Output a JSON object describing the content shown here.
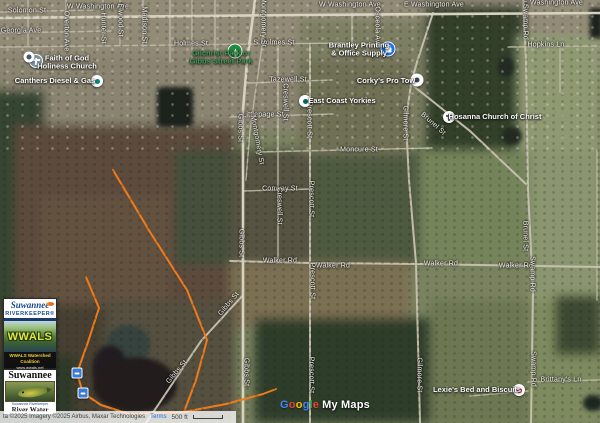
{
  "map": {
    "street_labels": [
      {
        "text": "Solomon St",
        "x": 27,
        "y": 11,
        "rot": 0
      },
      {
        "text": "W Washington Ave",
        "x": 98,
        "y": 7,
        "rot": 0
      },
      {
        "text": "W Washington Ave",
        "x": 350,
        "y": 5,
        "rot": 0
      },
      {
        "text": "E Washington Ave",
        "x": 434,
        "y": 5,
        "rot": 0
      },
      {
        "text": "E Washington Ave",
        "x": 553,
        "y": 3,
        "rot": 0
      },
      {
        "text": "Georgia Ave",
        "x": 21,
        "y": 31,
        "rot": 0
      },
      {
        "text": "Holmes St",
        "x": 191,
        "y": 44,
        "rot": 0
      },
      {
        "text": "S Holmes St",
        "x": 274,
        "y": 43,
        "rot": 0
      },
      {
        "text": "Tazewell St",
        "x": 288,
        "y": 80,
        "rot": 0
      },
      {
        "text": "Littlepage St",
        "x": 263,
        "y": 115,
        "rot": 0
      },
      {
        "text": "Moncure St",
        "x": 359,
        "y": 150,
        "rot": 0
      },
      {
        "text": "Conway St",
        "x": 280,
        "y": 189,
        "rot": 0
      },
      {
        "text": "Walker Rd",
        "x": 280,
        "y": 261,
        "rot": 0
      },
      {
        "text": "Walker Rd",
        "x": 333,
        "y": 266,
        "rot": 0
      },
      {
        "text": "Walker Rd",
        "x": 441,
        "y": 264,
        "rot": 0
      },
      {
        "text": "Walker Rd",
        "x": 516,
        "y": 266,
        "rot": 0
      },
      {
        "text": "Hopkins Ln",
        "x": 546,
        "y": 45,
        "rot": 0
      },
      {
        "text": "Brittany's Ln",
        "x": 561,
        "y": 380,
        "rot": 0
      },
      {
        "text": "Overton Ave",
        "x": 66,
        "y": 31,
        "rot": 90
      },
      {
        "text": "Hunter St",
        "x": 103,
        "y": 28,
        "rot": 90
      },
      {
        "text": "Elwood St",
        "x": 120,
        "y": 20,
        "rot": 90
      },
      {
        "text": "Madison St",
        "x": 144,
        "y": 25,
        "rot": 90
      },
      {
        "text": "Montgomery St",
        "x": 263,
        "y": 22,
        "rot": 90
      },
      {
        "text": "Montgomery St",
        "x": 257,
        "y": 140,
        "rot": 80
      },
      {
        "text": "Gibbs St",
        "x": 240,
        "y": 128,
        "rot": 90
      },
      {
        "text": "Gibbs St",
        "x": 241,
        "y": 243,
        "rot": 90
      },
      {
        "text": "Gibbs St",
        "x": 246,
        "y": 372,
        "rot": 90
      },
      {
        "text": "Gibbs St",
        "x": 177,
        "y": 372,
        "rot": -50
      },
      {
        "text": "Gibbs St",
        "x": 229,
        "y": 304,
        "rot": -50
      },
      {
        "text": "Creswell St",
        "x": 285,
        "y": 102,
        "rot": 90
      },
      {
        "text": "Creswell St",
        "x": 279,
        "y": 206,
        "rot": 90
      },
      {
        "text": "Prescott St",
        "x": 309,
        "y": 120,
        "rot": 90
      },
      {
        "text": "Prescott St",
        "x": 311,
        "y": 199,
        "rot": 90
      },
      {
        "text": "Prescott St",
        "x": 312,
        "y": 281,
        "rot": 90
      },
      {
        "text": "Prescott St",
        "x": 311,
        "y": 375,
        "rot": 90
      },
      {
        "text": "Gilmore St",
        "x": 405,
        "y": 123,
        "rot": 90
      },
      {
        "text": "Gilmore St",
        "x": 419,
        "y": 375,
        "rot": 90
      },
      {
        "text": "Swamp Rd",
        "x": 525,
        "y": 22,
        "rot": 90
      },
      {
        "text": "Swamp Rd",
        "x": 532,
        "y": 274,
        "rot": 90
      },
      {
        "text": "Swamp Rd",
        "x": 533,
        "y": 369,
        "rot": 90
      },
      {
        "text": "Brunel St",
        "x": 433,
        "y": 124,
        "rot": 42
      },
      {
        "text": "Brunel St",
        "x": 525,
        "y": 236,
        "rot": 90
      },
      {
        "text": "Osceola Ave",
        "x": 377,
        "y": 27,
        "rot": 90
      }
    ],
    "pois": [
      {
        "id": "gilchrist-park",
        "label_lines": [
          "Gilchrist Park or",
          "Gibbs Street Park"
        ],
        "label_x": 221,
        "label_y": 58,
        "label_color": "#3d9b4f",
        "marker": {
          "x": 235,
          "y": 51,
          "size": 13,
          "bg": "#1e8e3e",
          "ring": true,
          "icon": "tree-icon",
          "icon_color": "#ffffff"
        }
      },
      {
        "id": "faith-of-god-holiness-church",
        "label_lines": [
          "Faith of God",
          "Holiness Church"
        ],
        "label_x": 67,
        "label_y": 63,
        "label_color": "#fdfdfd",
        "marker": {
          "x": 36,
          "y": 61,
          "size": 12,
          "bg": "#7d95a3",
          "ring": true,
          "icon": "cross-icon",
          "icon_color": "#ffffff"
        }
      },
      {
        "id": "unnamed-place",
        "label_lines": [],
        "label_x": 0,
        "label_y": 0,
        "label_color": "#fdfdfd",
        "marker": {
          "x": 29,
          "y": 57,
          "size": 11,
          "bg": "#ffffff",
          "ring": false,
          "icon": "dot-icon",
          "icon_color": "#455a64"
        }
      },
      {
        "id": "canthers-diesel-gas",
        "label_lines": [
          "Canthers Diesel & Gas"
        ],
        "label_x": 55,
        "label_y": 81,
        "label_color": "#fdfdfd",
        "marker": {
          "x": 97,
          "y": 81,
          "size": 12,
          "bg": "#ffffff",
          "ring": false,
          "icon": "fuel-icon",
          "icon_color": "#00897b"
        }
      },
      {
        "id": "brantley-printing-office-supply",
        "label_lines": [
          "Brantley Printing",
          "& Office Supply"
        ],
        "label_x": 359,
        "label_y": 50,
        "label_color": "#fdfdfd",
        "marker": {
          "x": 388,
          "y": 49,
          "size": 13,
          "bg": "#1a73e8",
          "ring": true,
          "icon": "shopping-bag-icon",
          "icon_color": "#ffffff"
        }
      },
      {
        "id": "corkys-pro-tow",
        "label_lines": [
          "Corky's Pro Tow"
        ],
        "label_x": 386,
        "label_y": 81,
        "label_color": "#fdfdfd",
        "marker": {
          "x": 417,
          "y": 80,
          "size": 13,
          "bg": "#ffffff",
          "ring": false,
          "icon": "tow-truck-icon",
          "icon_color": "#37474f"
        }
      },
      {
        "id": "east-coast-yorkies",
        "label_lines": [
          "East Coast Yorkies"
        ],
        "label_x": 342,
        "label_y": 101,
        "label_color": "#fdfdfd",
        "marker": {
          "x": 305,
          "y": 101,
          "size": 12,
          "bg": "#ffffff",
          "ring": false,
          "icon": "paw-icon",
          "icon_color": "#00695c"
        }
      },
      {
        "id": "hosanna-church-of-christ",
        "label_lines": [
          "Hosanna Church of Christ"
        ],
        "label_x": 495,
        "label_y": 117,
        "label_color": "#fdfdfd",
        "marker": {
          "x": 449,
          "y": 117,
          "size": 12,
          "bg": "#ffffff",
          "ring": false,
          "icon": "cross-icon",
          "icon_color": "#6a6a6a"
        }
      },
      {
        "id": "lexies-bed-and-biscuits",
        "label_lines": [
          "Lexie's Bed and Biscuits"
        ],
        "label_x": 477,
        "label_y": 390,
        "label_color": "#fdfdfd",
        "marker": {
          "x": 519,
          "y": 390,
          "size": 12,
          "bg": "#ffffff",
          "ring": false,
          "icon": "paw-icon",
          "icon_color": "#e91e63"
        }
      }
    ],
    "access_points": [
      {
        "id": "river-access-point-1",
        "x": 77,
        "y": 373,
        "color": "#3a7bd5",
        "icon": "boat-ramp-icon"
      },
      {
        "id": "river-access-point-2",
        "x": 83,
        "y": 393,
        "color": "#3a7bd5",
        "icon": "boat-ramp-icon"
      }
    ],
    "trail_color": "#ef7b1a"
  },
  "overlays": {
    "riverkeeper_logo": {
      "title": "Suwannee",
      "subtitle": "RIVERKEEPER®",
      "art_text": "WWALS",
      "footer_line1": "WWALS Watershed Coalition",
      "footer_line2": "www.wwals.net"
    },
    "water_trail_logo": {
      "title": "Suwannee",
      "riverkeeper_line": "Suwannee Riverkeeper",
      "caption": "River Water Trail"
    }
  },
  "footer": {
    "attribution": "ta ©2025 Imagery ©2025 Airbus, Maxar Technologies",
    "terms": "Terms",
    "scale_label": "500 ft"
  },
  "watermark": {
    "letters": [
      {
        "ch": "G",
        "color": "#4285F4"
      },
      {
        "ch": "o",
        "color": "#EA4335"
      },
      {
        "ch": "o",
        "color": "#FBBC05"
      },
      {
        "ch": "g",
        "color": "#4285F4"
      },
      {
        "ch": "l",
        "color": "#34A853"
      },
      {
        "ch": "e",
        "color": "#EA4335"
      }
    ],
    "suffix": "My Maps"
  }
}
